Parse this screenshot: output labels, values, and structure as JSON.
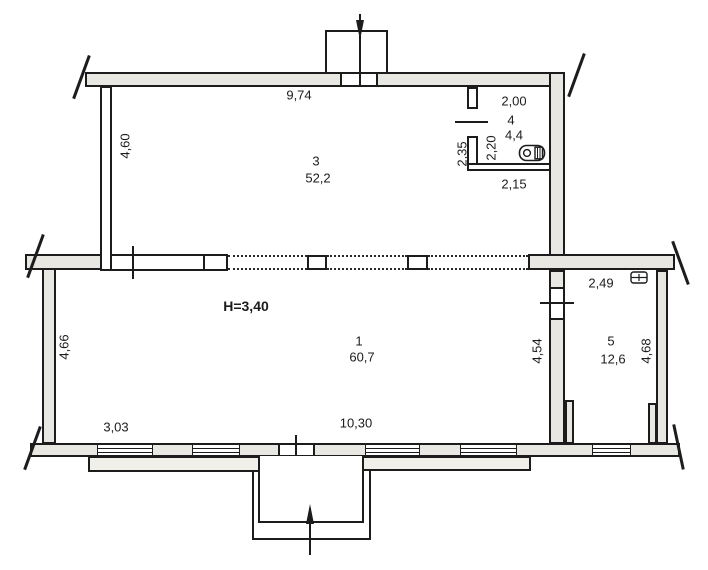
{
  "drawing": {
    "type": "floor-plan",
    "height_note": "H=3,40"
  },
  "rooms": [
    {
      "number": "3",
      "area": "52,2"
    },
    {
      "number": "4",
      "area": "4,4"
    },
    {
      "number": "1",
      "area": "60,7"
    },
    {
      "number": "5",
      "area": "12,6"
    }
  ],
  "dimensions": {
    "room3_top_width": "9,74",
    "room3_left_height": "4,60",
    "room4_top_width": "2,00",
    "room4_left_outer": "2,35",
    "room4_left_inner": "2,20",
    "room4_bottom_width": "2,15",
    "room5_top_width": "2,49",
    "room1_left_height": "4,66",
    "room1_window_left": "3,03",
    "room1_bottom_width": "10,30",
    "room1_right_height": "4,54",
    "room5_right_height": "4,68"
  },
  "icons": {
    "toilet": "toilet-plan-symbol",
    "sink": "sink-plan-symbol",
    "entrance_top": "arrow-down",
    "entrance_bottom": "arrow-up"
  },
  "colors": {
    "wall_fill": "#e9e7e1",
    "line": "#1c1c1c",
    "background": "#ffffff"
  }
}
